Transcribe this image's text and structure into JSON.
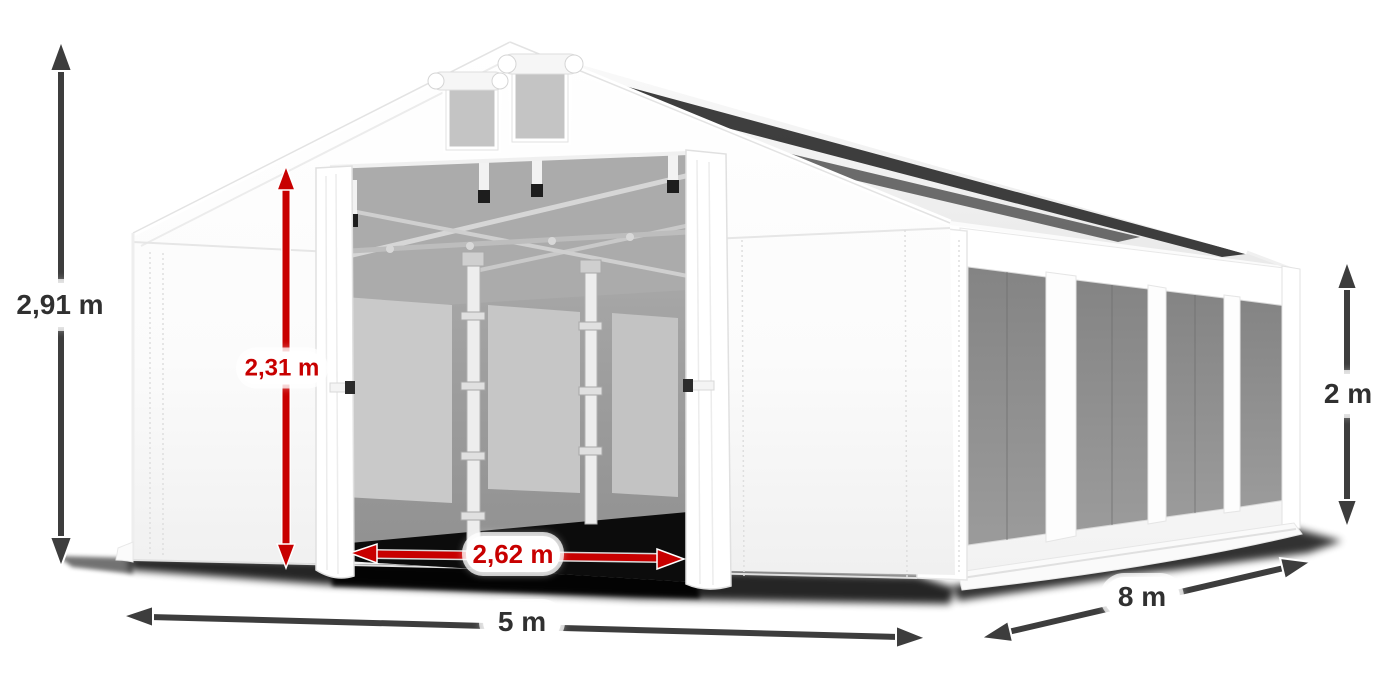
{
  "diagram": {
    "subject": "white-party-tent-with-dimensions",
    "dimensions": {
      "total_height": "2,91 m",
      "door_height": "2,31 m",
      "door_width": "2,62 m",
      "front_width": "5 m",
      "side_length": "8 m",
      "side_wall_height": "2 m"
    },
    "colors": {
      "dimension_arrow_gray": "#3d3d3d",
      "dimension_arrow_red": "#c80000",
      "label_text_dark": "#303030",
      "label_text_red": "#c80000",
      "tent_white": "#ffffff",
      "tent_shading": "#f1f1f1",
      "mesh_window_gray": "#8c8c8c",
      "interior_gray": "#a0a0a0",
      "ground_shadow": "#000000"
    }
  }
}
